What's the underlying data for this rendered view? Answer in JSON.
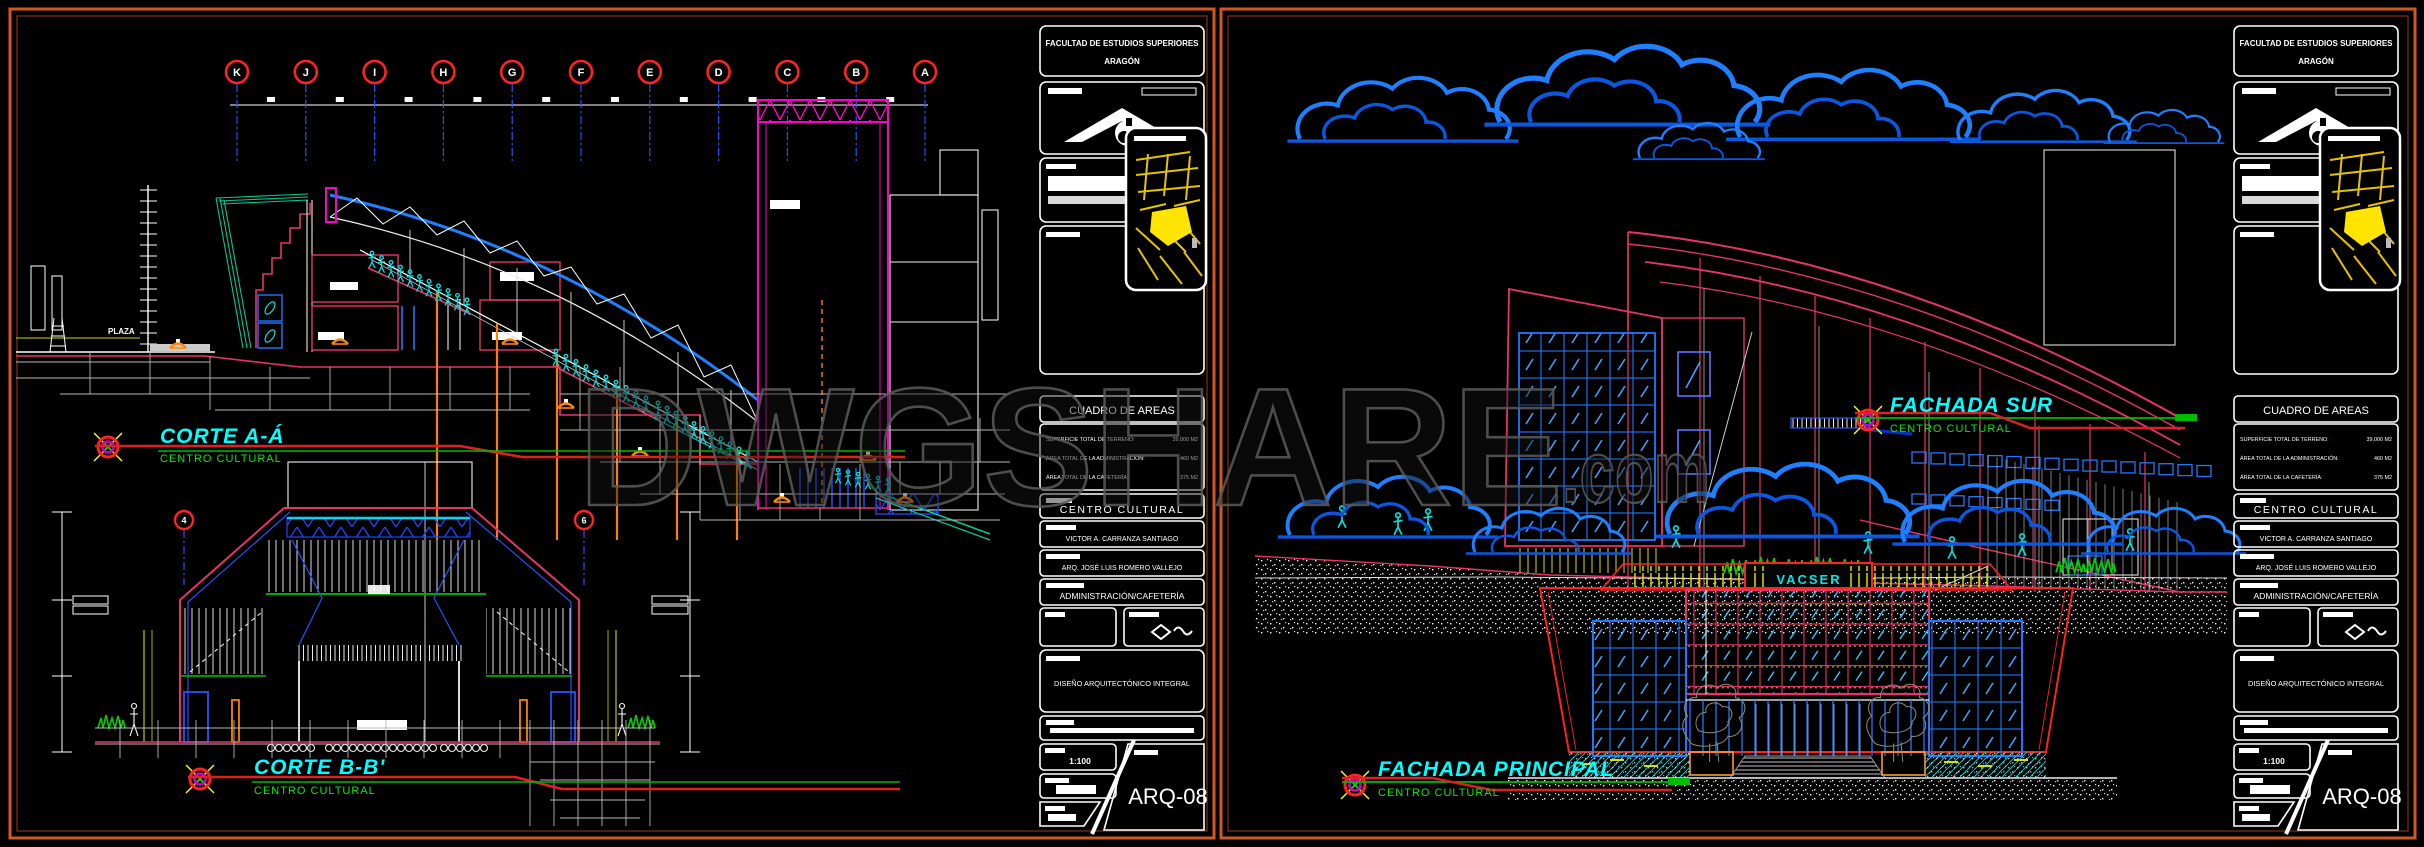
{
  "watermark": {
    "text": "DWGSHARE",
    "suffix": ".com"
  },
  "title_block": {
    "institution_line1": "FACULTAD DE ESTUDIOS SUPERIORES",
    "institution_line2": "ARAGÓN",
    "cuadro_title": "CUADRO DE AREAS",
    "areas": [
      {
        "label": "SUPERFICIE TOTAL DE TERRENO:",
        "value": "39,000 M2"
      },
      {
        "label": "ÁREA TOTAL DE LA ADMINISTRACIÓN:",
        "value": "460 M2"
      },
      {
        "label": "ÁREA TOTAL DE LA CAFETERÍA:",
        "value": "375 M2"
      }
    ],
    "project": "CENTRO CULTURAL",
    "author": "VICTOR A. CARRANZA SANTIAGO",
    "advisor": "ARQ. JOSÉ LUIS ROMERO VALLEJO",
    "content": "ADMINISTRACIÓN/CAFETERÍA",
    "course": "DISEÑO ARQUITECTÓNICO INTEGRAL",
    "scale": "1:100",
    "sheet_number": "ARQ-08"
  },
  "labels": {
    "corte_a": {
      "title": "CORTE A-Á",
      "subtitle": "CENTRO CULTURAL"
    },
    "corte_b": {
      "title": "CORTE B-B'",
      "subtitle": "CENTRO CULTURAL"
    },
    "fachada_sur": {
      "title": "FACHADA SUR",
      "subtitle": "CENTRO CULTURAL"
    },
    "fachada_principal": {
      "title": "FACHADA PRINCIPAL",
      "subtitle": "CENTRO CULTURAL"
    }
  },
  "left_sheet": {
    "grid_letters": [
      "K",
      "J",
      "I",
      "H",
      "G",
      "F",
      "E",
      "D",
      "C",
      "B",
      "A"
    ],
    "section_bubbles": [
      "4",
      "6"
    ],
    "plaza_label": "PLAZA"
  },
  "right_sheet": {
    "sign_text": "VACSER"
  },
  "colors": {
    "border": "#d4571e",
    "label_title": "#00ffff",
    "label_subtitle": "#00ee00",
    "crimson": "#e8336a",
    "magenta": "#ff00cc",
    "blue": "#2277ff",
    "cloud": "#1e7fff",
    "teal": "#00c89a",
    "orange": "#ff7f00",
    "yellow": "#ffff00",
    "red": "#ff2222"
  }
}
